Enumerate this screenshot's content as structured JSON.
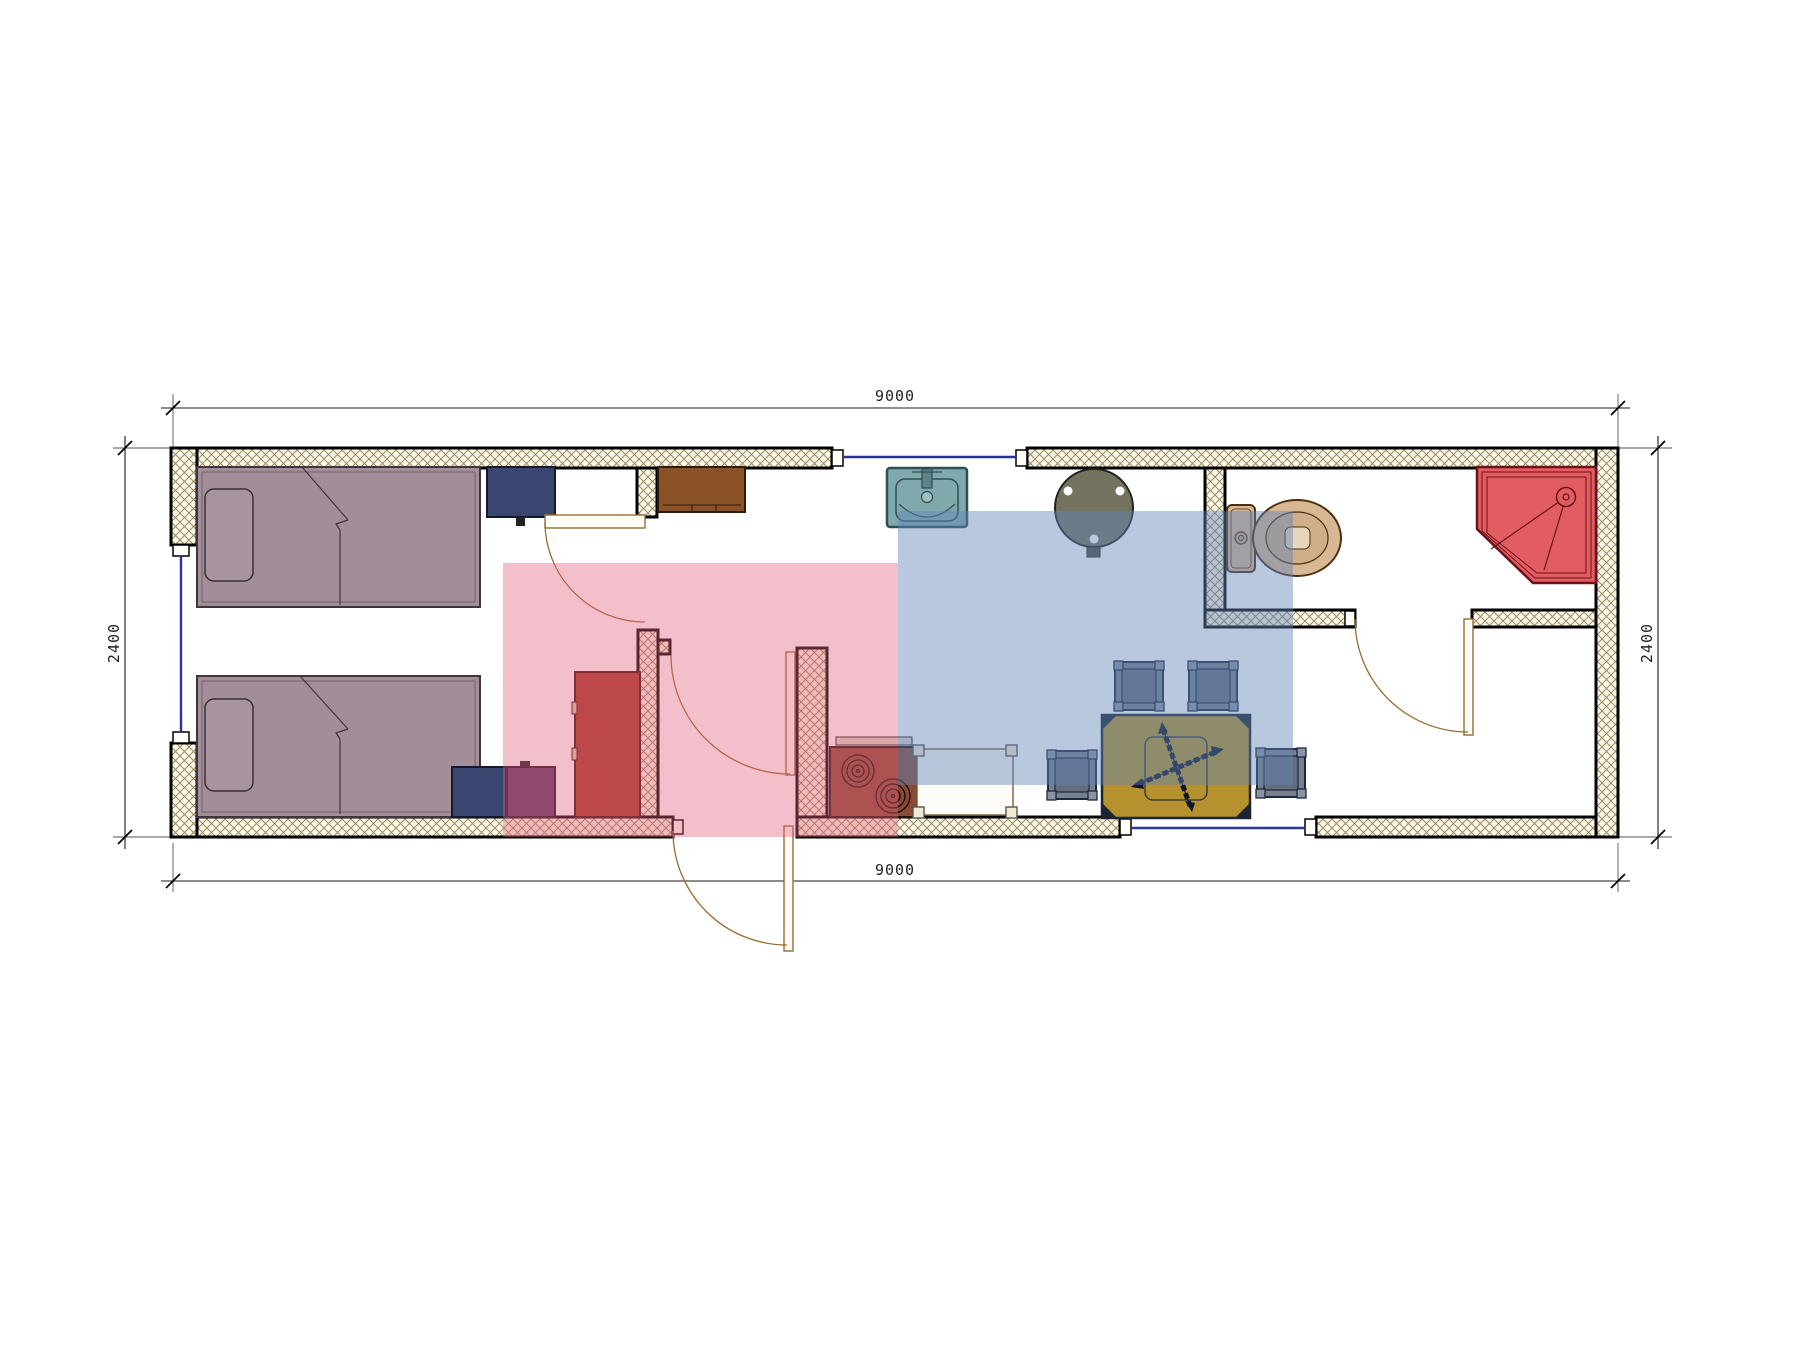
{
  "document": {
    "type": "architectural floor plan drawing",
    "background": "#ffffff"
  },
  "dimensions": {
    "top": "9000",
    "bottom": "9000",
    "left": "2400",
    "right": "2400"
  },
  "watermark": {
    "text": "VANDA",
    "pink_block": "#e0607e",
    "blue_block": "#6286b8"
  },
  "plan": {
    "walls": {
      "hatch_line": "#9b8b58",
      "edge": "#000000",
      "fill": "#fbf7ec"
    },
    "windows": {
      "color": "#283593"
    },
    "doors": {
      "arc_color": "#9a6a30"
    },
    "furniture": [
      {
        "name": "single-bed-top",
        "color": "#a28e98"
      },
      {
        "name": "single-bed-bottom",
        "color": "#a28e98"
      },
      {
        "name": "nightstand-navy-top",
        "color": "#3a4570"
      },
      {
        "name": "nightstand-navy-bottom",
        "color": "#3a4570"
      },
      {
        "name": "cabinet-purple",
        "color": "#5c3a66"
      },
      {
        "name": "wardrobe-red",
        "color": "#a33a28"
      },
      {
        "name": "cabinet-brown",
        "color": "#8c5227"
      },
      {
        "name": "kitchen-sink",
        "color": "#7fa9ac"
      },
      {
        "name": "round-table",
        "color": "#73735f"
      },
      {
        "name": "stove",
        "color": "#8a4a35"
      },
      {
        "name": "counter-table",
        "color": "#fdfcf8"
      },
      {
        "name": "dining-table",
        "color": "#b5922e"
      },
      {
        "name": "stool",
        "count": 4,
        "color": "#77808f"
      },
      {
        "name": "toilet",
        "color": "#d8b795"
      },
      {
        "name": "corner-shower",
        "color": "#e25d62"
      }
    ]
  }
}
